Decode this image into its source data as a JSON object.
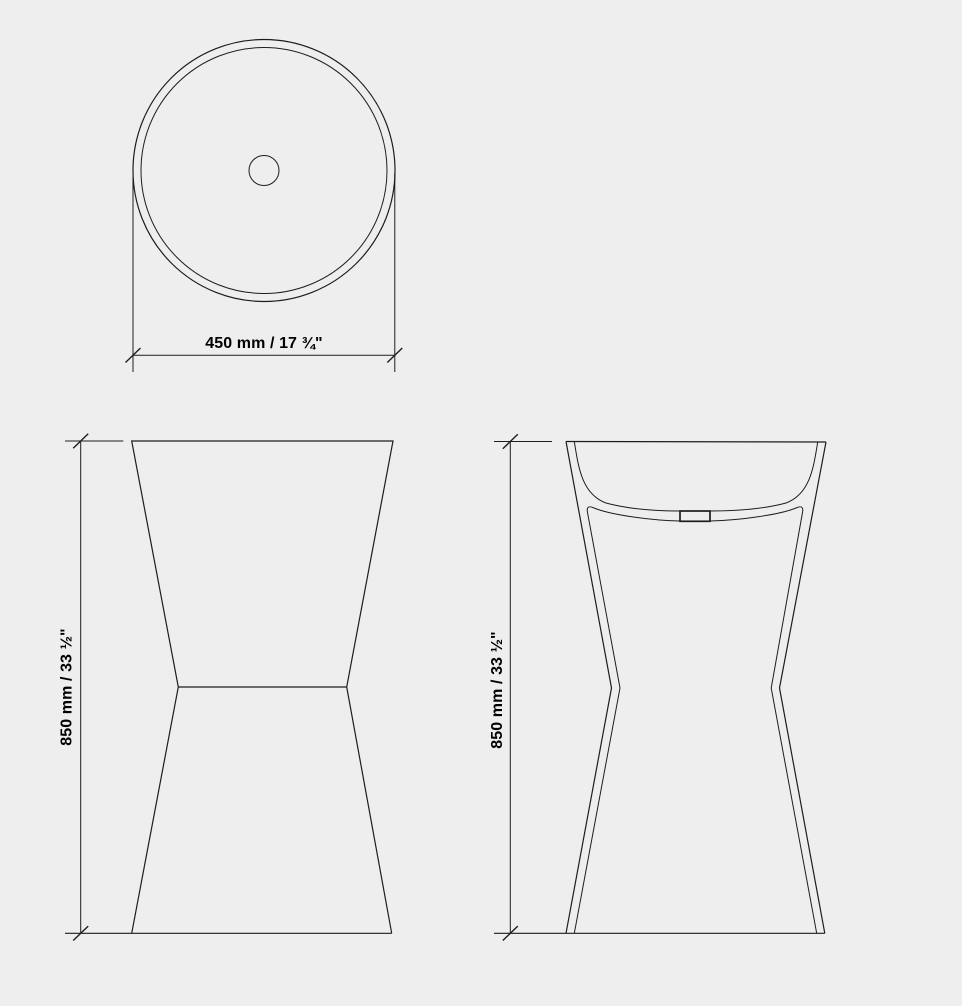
{
  "colors": {
    "background": "#eeeeee",
    "line": "#1d1d1b",
    "text": "#000000"
  },
  "views": {
    "top_view": {
      "width_dimension_label": "450 mm / 17 ¾\""
    },
    "front_view": {
      "height_dimension_label": "850 mm / 33 ½\""
    },
    "section_view": {
      "height_dimension_label": "850 mm / 33 ½\""
    }
  }
}
